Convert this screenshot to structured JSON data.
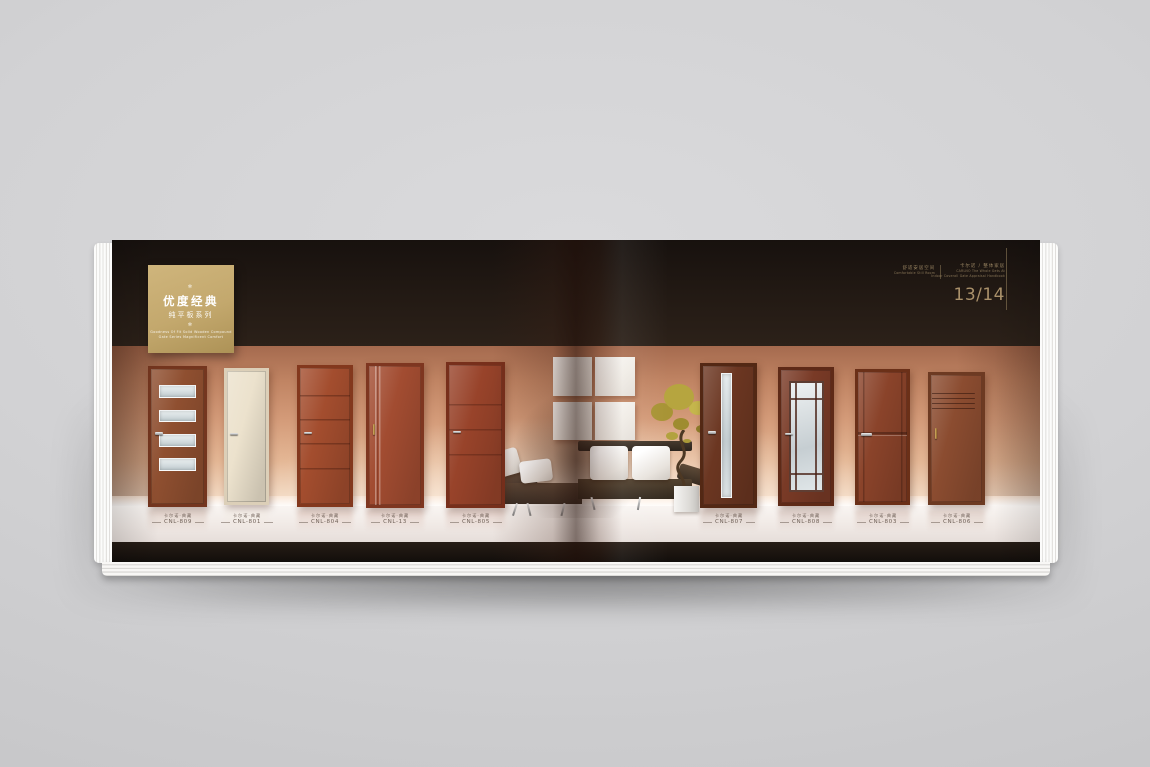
{
  "colors": {
    "gold-box": "#c3a86d",
    "page-number": "#a9906a",
    "header-text": "#9b8663",
    "label-text": "#6f6158",
    "band": "#201813"
  },
  "cover_box": {
    "ornament": "✻",
    "title": "优度经典",
    "subtitle": "纯平板系列",
    "caption_line1": "Goodness Of Fit Solid Wooden Compound",
    "caption_line2": "Gate Series Magnificent Comfort"
  },
  "header": {
    "section": {
      "zh": "舒适安居空间",
      "en": "Comfortable Still Room"
    },
    "brand": {
      "zh": "卡尔诺 / 整体家居",
      "en_line1": "CARLNO The Whole Gets At",
      "en_line2": "Indoor Coverall Gate Appraisal Handbook"
    },
    "page_number": "13/14"
  },
  "doors": [
    {
      "series": "卡尔诺·典藏",
      "code": "CNL-809",
      "color": "#8f4f30",
      "frame": "#74361f"
    },
    {
      "series": "卡尔诺·典藏",
      "code": "CNL-801",
      "color": "#ece2cd",
      "frame": "#dccfb8"
    },
    {
      "series": "卡尔诺·典藏",
      "code": "CNL-804",
      "color": "#a34d2e",
      "frame": "#83381d"
    },
    {
      "series": "卡尔诺·典藏",
      "code": "CNL-13",
      "color": "#a24c31",
      "frame": "#7e3620"
    },
    {
      "series": "卡尔诺·典藏",
      "code": "CNL-805",
      "color": "#98432a",
      "frame": "#772f1b"
    },
    {
      "series": "卡尔诺·典藏",
      "code": "CNL-807",
      "color": "#6b3621",
      "frame": "#532814"
    },
    {
      "series": "卡尔诺·典藏",
      "code": "CNL-808",
      "color": "#793a26",
      "frame": "#5e2a17"
    },
    {
      "series": "卡尔诺·典藏",
      "code": "CNL-803",
      "color": "#8a432a",
      "frame": "#6b3018"
    },
    {
      "series": "卡尔诺·典藏",
      "code": "CNL-806",
      "color": "#8b4c30",
      "frame": "#6d3a22"
    }
  ]
}
